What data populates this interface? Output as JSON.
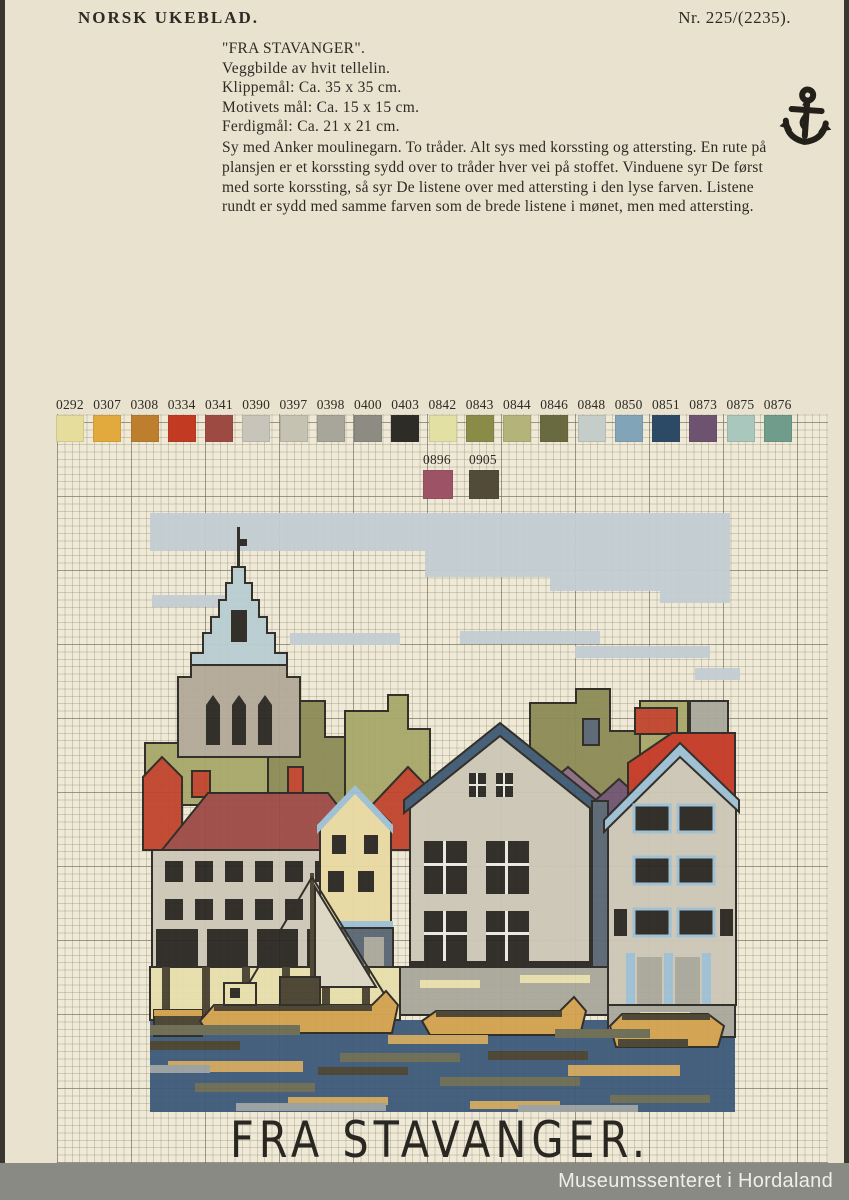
{
  "page": {
    "masthead": "NORSK UKEBLAD.",
    "issue": "Nr. 225/(2235).",
    "watermark": "Museumssenteret i Hordaland"
  },
  "header_block": {
    "title": "\"FRA STAVANGER\".",
    "subtitle": "Veggbilde av hvit tellelin.",
    "specs": [
      "Klippemål: Ca. 35 x 35 cm.",
      "Motivets mål: Ca. 15 x 15 cm.",
      "Ferdigmål: Ca. 21 x 21 cm."
    ],
    "instructions": "Sy med Anker moulinegarn. To tråder. Alt sys med korssting og attersting. En rute på plansjen er et korssting sydd over to tråder hver vei på stoffet. Vinduene syr De først med sorte korssting, så syr De listene over med attersting i den lyse farven. Listene rundt er sydd med samme farven som de brede listene i mønet, men med attersting.",
    "brand_icon": "anchor-icon"
  },
  "palette_row1": [
    {
      "code": "0292",
      "color": "#e6dc9c"
    },
    {
      "code": "0307",
      "color": "#e2a93c"
    },
    {
      "code": "0308",
      "color": "#bd7f2e"
    },
    {
      "code": "0334",
      "color": "#c23a22"
    },
    {
      "code": "0341",
      "color": "#9c4a42"
    },
    {
      "code": "0390",
      "color": "#c7c5ba"
    },
    {
      "code": "0397",
      "color": "#c5c2b2"
    },
    {
      "code": "0398",
      "color": "#a8a69b"
    },
    {
      "code": "0400",
      "color": "#8e8c82"
    },
    {
      "code": "0403",
      "color": "#2e2c27"
    },
    {
      "code": "0842",
      "color": "#e3e0a4"
    },
    {
      "code": "0843",
      "color": "#8b8b48"
    },
    {
      "code": "0844",
      "color": "#b4b379"
    },
    {
      "code": "0846",
      "color": "#6a6a40"
    },
    {
      "code": "0848",
      "color": "#c4cdc9"
    },
    {
      "code": "0850",
      "color": "#82a4b8"
    },
    {
      "code": "0851",
      "color": "#2c4a66"
    },
    {
      "code": "0873",
      "color": "#6e5370"
    },
    {
      "code": "0875",
      "color": "#aac7bd"
    },
    {
      "code": "0876",
      "color": "#6f9c8b"
    }
  ],
  "palette_row2": [
    {
      "code": "0896",
      "color": "#9d5365"
    },
    {
      "code": "0905",
      "color": "#524b38"
    }
  ],
  "motif": {
    "caption": "FRA STAVANGER.",
    "colors": {
      "ink": "#2a2722",
      "sky": "#c3ced3",
      "spire": "#b9cdd2",
      "stone": "#b2a999",
      "treeL": "#a8a76a",
      "treeD": "#8d8b55",
      "roofR": "#c0442c",
      "roofM": "#9d4a45",
      "roofMv": "#8d6b80",
      "roofP": "#6f5470",
      "roofBR": "#c43a26",
      "slate": "#596673",
      "wall": "#cdc7b7",
      "wallY": "#e9daa3",
      "trimN": "#3d5a74",
      "trimLB": "#9dbfd4",
      "white": "#e9e9e1",
      "quay": "#a9a89c",
      "pierY": "#e7dfab",
      "sailC": "#ddd8c6",
      "boatG": "#d2a24f",
      "boatD": "#48412f",
      "waterB": "#3d5a7a",
      "waterO": "#6b6a52",
      "waterT": "#cda45c",
      "waterG": "#98a0a0"
    },
    "shapes": [
      [
        "r",
        10,
        8,
        580,
        38,
        "sky"
      ],
      [
        "r",
        285,
        46,
        305,
        26,
        "sky"
      ],
      [
        "r",
        410,
        72,
        180,
        14,
        "sky"
      ],
      [
        "r",
        520,
        86,
        70,
        12,
        "sky"
      ],
      [
        "r",
        12,
        90,
        90,
        12,
        "sky"
      ],
      [
        "r",
        150,
        128,
        110,
        12,
        "sky"
      ],
      [
        "r",
        320,
        126,
        140,
        13,
        "sky"
      ],
      [
        "r",
        435,
        141,
        135,
        12,
        "sky"
      ],
      [
        "r",
        555,
        163,
        55,
        12,
        "sky"
      ],
      [
        "p",
        "5,238 40,238 40,214 78,214 78,200 110,200 110,238 128,238 128,300 5,300",
        "treeL",
        1
      ],
      [
        "p",
        "128,214 160,214 160,196 185,196 185,232 205,232 205,300 128,300",
        "treeD",
        1
      ],
      [
        "p",
        "205,206 248,206 248,190 268,190 268,224 290,224 290,300 205,300",
        "treeL",
        1
      ],
      [
        "p",
        "390,198 436,198 436,184 470,184 470,226 500,226 500,292 390,292",
        "treeD",
        1
      ],
      [
        "p",
        "500,196 548,196 548,228 588,228 588,292 500,292",
        "treeL",
        1
      ],
      [
        "r",
        97,
        22,
        3,
        42,
        "ink"
      ],
      [
        "r",
        100,
        34,
        7,
        7,
        "ink"
      ],
      [
        "p",
        "92,62 105,62 105,78 112,78 112,95 119,95 119,112 127,112 127,128 135,128 135,148 147,148 147,160 51,160 51,148 63,148 63,128 71,128 71,112 79,112 79,95 86,95 86,78 92,78",
        "spire",
        1
      ],
      [
        "r",
        91,
        105,
        16,
        32,
        "ink"
      ],
      [
        "p",
        "51,160 147,160 147,172 160,172 160,252 38,252 38,172 51,172",
        "stone",
        1
      ],
      [
        "p",
        "66,200 73,190 80,200 80,240 66,240",
        "ink"
      ],
      [
        "p",
        "92,200 99,190 106,200 106,240 92,240",
        "ink"
      ],
      [
        "p",
        "118,200 125,190 132,200 132,240 118,240",
        "ink"
      ],
      [
        "r",
        52,
        266,
        18,
        26,
        "roofR",
        1
      ],
      [
        "r",
        148,
        262,
        15,
        26,
        "roofR",
        1
      ],
      [
        "p",
        "3,272 22,252 42,272 42,345 3,345",
        "roofR",
        1
      ],
      [
        "p",
        "22,345 68,288 188,288 232,345",
        "roofM",
        1
      ],
      [
        "p",
        "232,300 268,262 305,300 305,345 232,345",
        "roofR",
        1
      ],
      [
        "r",
        495,
        203,
        42,
        26,
        "roofR",
        1
      ],
      [
        "p",
        "393,292 428,262 463,292 463,350 393,350",
        "roofMv",
        1
      ],
      [
        "p",
        "448,302 479,274 510,302 510,355 448,355",
        "roofP",
        1
      ],
      [
        "r",
        443,
        214,
        16,
        26,
        "slate",
        1
      ],
      [
        "r",
        550,
        196,
        38,
        34,
        "quay",
        1
      ],
      [
        "p",
        "488,258 532,228 595,228 595,330 488,330",
        "roofBR",
        1
      ],
      [
        "r",
        12,
        345,
        192,
        118,
        "wall",
        1
      ],
      [
        "r",
        25,
        356,
        18,
        21,
        "ink"
      ],
      [
        "r",
        55,
        356,
        18,
        21,
        "ink"
      ],
      [
        "r",
        85,
        356,
        18,
        21,
        "ink"
      ],
      [
        "r",
        115,
        356,
        18,
        21,
        "ink"
      ],
      [
        "r",
        145,
        356,
        18,
        21,
        "ink"
      ],
      [
        "r",
        175,
        356,
        18,
        21,
        "ink"
      ],
      [
        "r",
        25,
        394,
        18,
        21,
        "ink"
      ],
      [
        "r",
        55,
        394,
        18,
        21,
        "ink"
      ],
      [
        "r",
        85,
        394,
        18,
        21,
        "ink"
      ],
      [
        "r",
        115,
        394,
        18,
        21,
        "ink"
      ],
      [
        "r",
        145,
        394,
        18,
        21,
        "ink"
      ],
      [
        "r",
        175,
        394,
        18,
        21,
        "ink"
      ],
      [
        "r",
        16,
        424,
        182,
        38,
        "ink"
      ],
      [
        "r",
        58,
        424,
        9,
        38,
        "wall"
      ],
      [
        "r",
        108,
        424,
        9,
        38,
        "wall"
      ],
      [
        "r",
        158,
        424,
        9,
        38,
        "wall"
      ],
      [
        "p",
        "180,318 215,284 251,318 251,420 180,420",
        "wallY",
        1
      ],
      [
        "p",
        "177,320 215,280 253,320 253,329 215,289 177,329",
        "trimLB"
      ],
      [
        "r",
        192,
        330,
        14,
        19,
        "ink"
      ],
      [
        "r",
        224,
        330,
        14,
        19,
        "ink"
      ],
      [
        "r",
        188,
        366,
        16,
        21,
        "ink"
      ],
      [
        "r",
        218,
        366,
        16,
        21,
        "ink"
      ],
      [
        "r",
        180,
        416,
        73,
        7,
        "trimLB"
      ],
      [
        "r",
        180,
        423,
        73,
        41,
        "slate",
        1
      ],
      [
        "r",
        190,
        432,
        20,
        32,
        "quay"
      ],
      [
        "r",
        224,
        432,
        20,
        32,
        "quay"
      ],
      [
        "p",
        "270,292 360,224 450,292 450,462 270,462",
        "wall",
        1
      ],
      [
        "p",
        "264,295 360,218 456,295 456,308 360,231 264,308",
        "trimN",
        1
      ],
      [
        "r",
        329,
        268,
        17,
        24,
        "ink"
      ],
      [
        "r",
        356,
        268,
        17,
        24,
        "ink"
      ],
      [
        "r",
        336,
        268,
        2,
        24,
        "white"
      ],
      [
        "r",
        363,
        268,
        2,
        24,
        "white"
      ],
      [
        "r",
        329,
        279,
        17,
        2,
        "white"
      ],
      [
        "r",
        356,
        279,
        17,
        2,
        "white"
      ],
      [
        "r",
        284,
        336,
        43,
        53,
        "ink"
      ],
      [
        "r",
        346,
        336,
        43,
        53,
        "ink"
      ],
      [
        "r",
        303,
        336,
        3,
        53,
        "white"
      ],
      [
        "r",
        365,
        336,
        3,
        53,
        "white"
      ],
      [
        "r",
        284,
        358,
        43,
        3,
        "white"
      ],
      [
        "r",
        346,
        358,
        43,
        3,
        "white"
      ],
      [
        "r",
        284,
        406,
        43,
        50,
        "ink"
      ],
      [
        "r",
        346,
        406,
        43,
        50,
        "ink"
      ],
      [
        "r",
        303,
        406,
        3,
        50,
        "white"
      ],
      [
        "r",
        365,
        406,
        3,
        50,
        "white"
      ],
      [
        "r",
        284,
        427,
        43,
        3,
        "white"
      ],
      [
        "r",
        346,
        427,
        43,
        3,
        "white"
      ],
      [
        "r",
        270,
        456,
        180,
        8,
        "ink"
      ],
      [
        "r",
        452,
        296,
        16,
        166,
        "slate",
        1
      ],
      [
        "p",
        "468,312 540,244 596,298 596,500 468,500",
        "wall",
        1
      ],
      [
        "p",
        "464,315 540,238 599,295 599,307 540,252 464,327",
        "trimLB",
        1
      ],
      [
        "r",
        494,
        300,
        36,
        27,
        "ink",
        "LB"
      ],
      [
        "r",
        538,
        300,
        36,
        27,
        "ink",
        "LB"
      ],
      [
        "r",
        494,
        352,
        36,
        27,
        "ink",
        "LB"
      ],
      [
        "r",
        538,
        352,
        36,
        27,
        "ink",
        "LB"
      ],
      [
        "r",
        494,
        404,
        36,
        27,
        "ink",
        "LB"
      ],
      [
        "r",
        538,
        404,
        36,
        27,
        "ink",
        "LB"
      ],
      [
        "r",
        474,
        404,
        13,
        27,
        "ink"
      ],
      [
        "r",
        580,
        404,
        13,
        27,
        "ink"
      ],
      [
        "r",
        486,
        448,
        9,
        52,
        "trimLB"
      ],
      [
        "r",
        524,
        448,
        9,
        52,
        "trimLB"
      ],
      [
        "r",
        562,
        448,
        9,
        52,
        "trimLB"
      ],
      [
        "r",
        497,
        452,
        25,
        48,
        "quay"
      ],
      [
        "r",
        535,
        452,
        25,
        48,
        "quay"
      ],
      [
        "r",
        10,
        515,
        585,
        92,
        "waterB"
      ],
      [
        "r",
        260,
        462,
        208,
        48,
        "quay",
        1
      ],
      [
        "r",
        280,
        475,
        60,
        8,
        "pierY"
      ],
      [
        "r",
        380,
        470,
        70,
        8,
        "pierY"
      ],
      [
        "r",
        468,
        500,
        127,
        32,
        "quay",
        1
      ],
      [
        "r",
        500,
        507,
        50,
        7,
        "pierY"
      ],
      [
        "r",
        10,
        462,
        250,
        53,
        "pierY",
        1
      ],
      [
        "r",
        22,
        462,
        8,
        53,
        "boatD"
      ],
      [
        "r",
        62,
        462,
        8,
        53,
        "boatD"
      ],
      [
        "r",
        102,
        462,
        8,
        53,
        "boatD"
      ],
      [
        "r",
        142,
        462,
        8,
        53,
        "boatD"
      ],
      [
        "r",
        182,
        462,
        8,
        53,
        "boatD"
      ],
      [
        "r",
        222,
        462,
        8,
        53,
        "boatD"
      ],
      [
        "r",
        170,
        368,
        4,
        147,
        "boatD"
      ],
      [
        "p",
        "175,382 236,482 175,482",
        "sailC",
        1
      ],
      [
        "l",
        172,
        372,
        248,
        495
      ],
      [
        "l",
        172,
        372,
        96,
        500
      ],
      [
        "r",
        14,
        505,
        48,
        26,
        "boatD",
        1
      ],
      [
        "r",
        14,
        505,
        48,
        6,
        "boatG"
      ],
      [
        "p",
        "60,516 74,500 232,500 246,486 258,500 252,528 68,528",
        "boatG",
        1
      ],
      [
        "r",
        74,
        500,
        158,
        6,
        "boatD"
      ],
      [
        "r",
        84,
        478,
        32,
        22,
        "pierY",
        1
      ],
      [
        "r",
        90,
        483,
        10,
        10,
        "ink"
      ],
      [
        "r",
        140,
        472,
        40,
        28,
        "boatD",
        1
      ],
      [
        "p",
        "282,516 296,506 420,506 434,492 446,506 440,530 290,530",
        "boatG",
        1
      ],
      [
        "r",
        296,
        506,
        126,
        6,
        "boatD"
      ],
      [
        "p",
        "470,521 482,509 568,509 584,521 578,542 476,542",
        "boatG",
        1
      ],
      [
        "r",
        482,
        509,
        88,
        6,
        "boatD"
      ],
      [
        "r",
        10,
        520,
        150,
        10,
        "waterO"
      ],
      [
        "r",
        200,
        548,
        120,
        9,
        "waterO"
      ],
      [
        "r",
        415,
        524,
        95,
        9,
        "waterO"
      ],
      [
        "r",
        300,
        572,
        140,
        9,
        "waterO"
      ],
      [
        "r",
        55,
        578,
        120,
        9,
        "waterO"
      ],
      [
        "r",
        470,
        590,
        100,
        8,
        "waterO"
      ],
      [
        "r",
        28,
        556,
        135,
        11,
        "waterT"
      ],
      [
        "r",
        248,
        530,
        100,
        9,
        "waterT"
      ],
      [
        "r",
        428,
        560,
        112,
        11,
        "waterT"
      ],
      [
        "r",
        148,
        592,
        100,
        8,
        "waterT"
      ],
      [
        "r",
        330,
        596,
        90,
        8,
        "waterT"
      ],
      [
        "r",
        10,
        536,
        90,
        9,
        "boatD"
      ],
      [
        "r",
        178,
        562,
        90,
        8,
        "boatD"
      ],
      [
        "r",
        348,
        546,
        100,
        9,
        "boatD"
      ],
      [
        "r",
        478,
        534,
        70,
        8,
        "boatD"
      ],
      [
        "r",
        96,
        598,
        150,
        8,
        "waterG"
      ],
      [
        "r",
        378,
        600,
        120,
        7,
        "waterG"
      ],
      [
        "r",
        10,
        560,
        60,
        8,
        "waterG"
      ]
    ]
  }
}
